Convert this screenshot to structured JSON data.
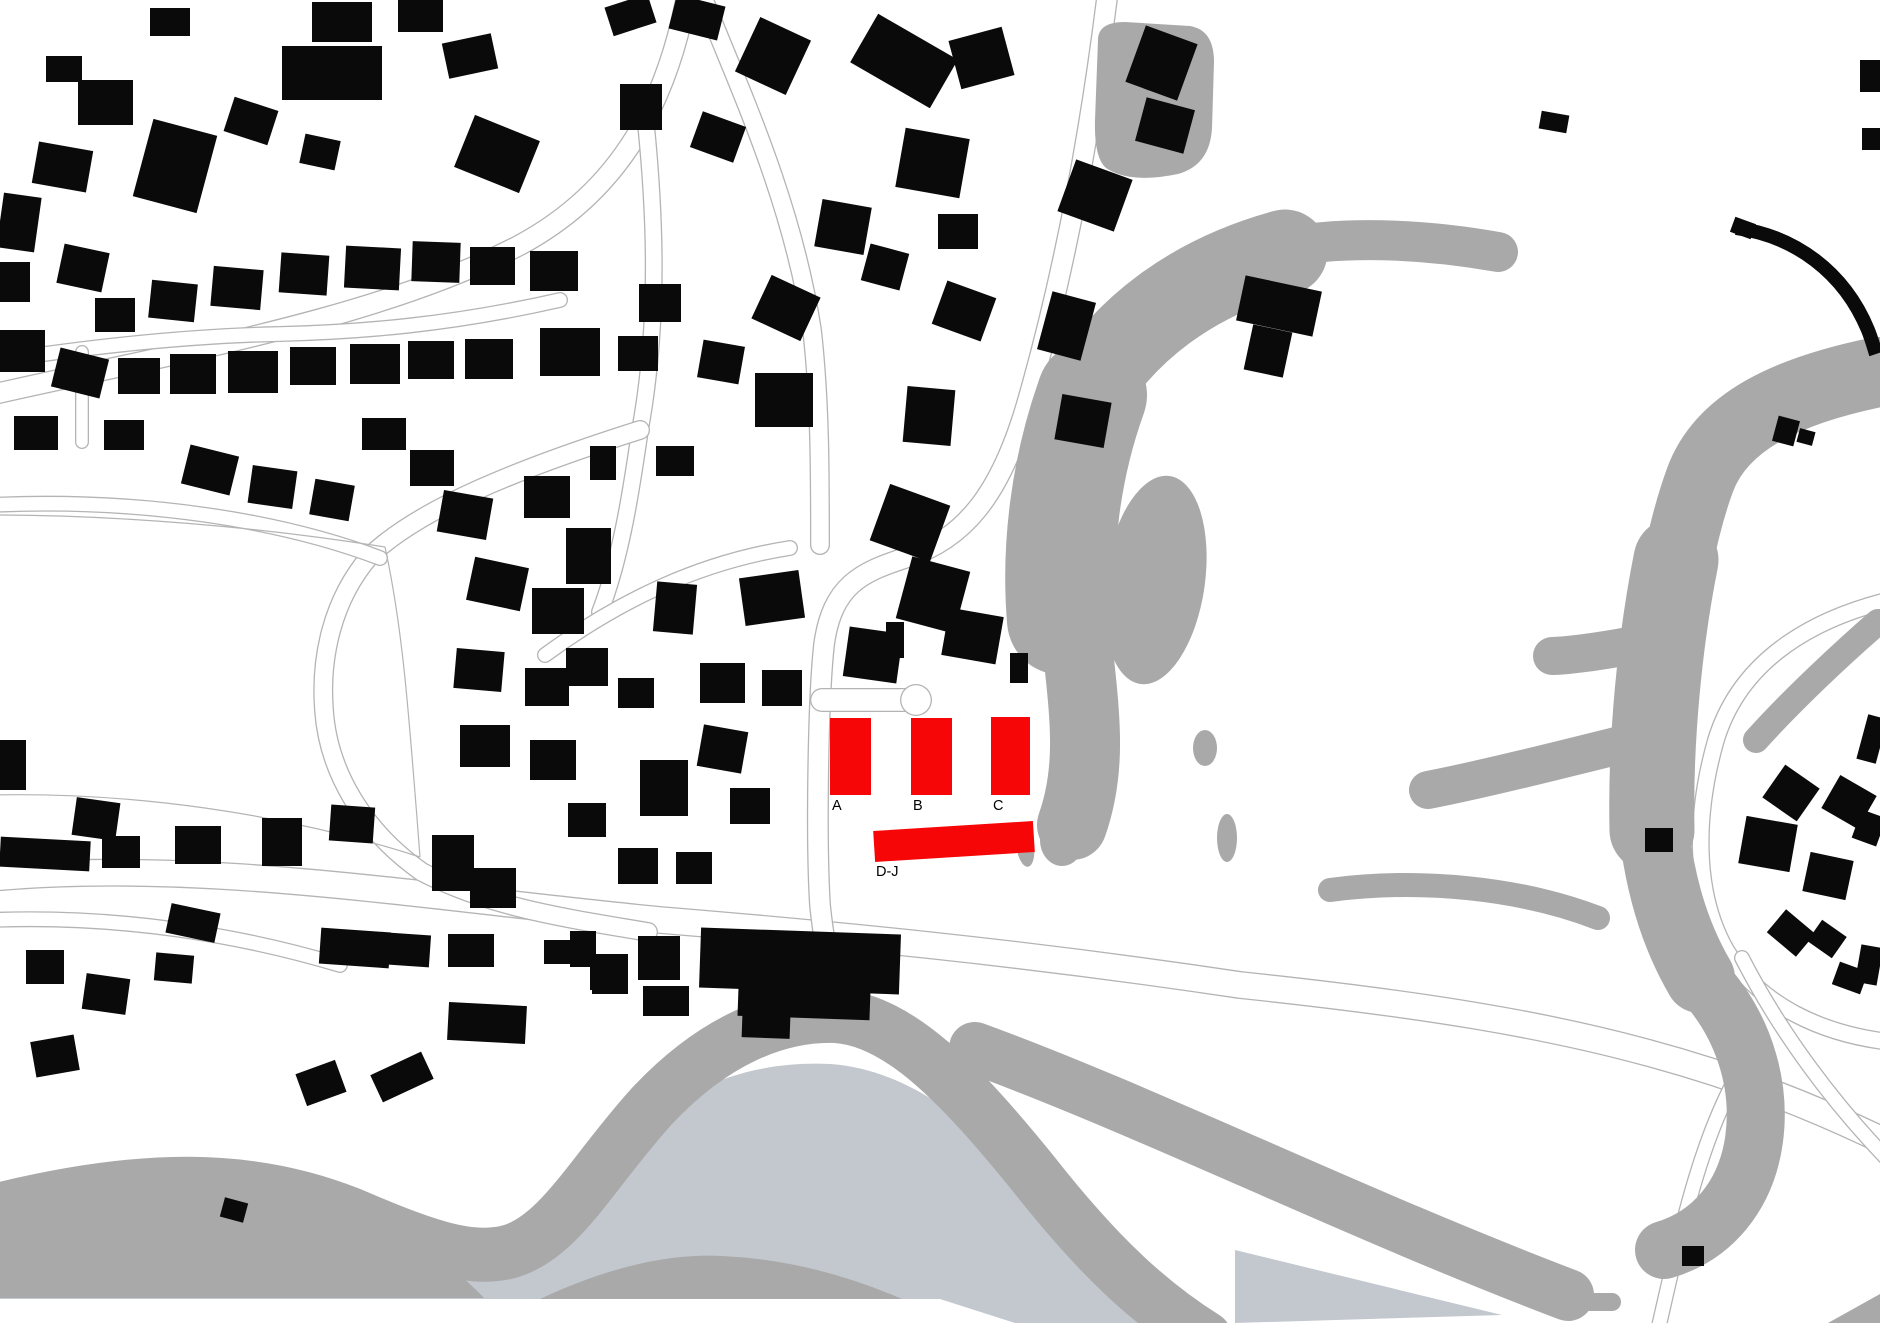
{
  "canvas": {
    "width": 1880,
    "height": 1323
  },
  "colors": {
    "background": "#ffffff",
    "building": "#0a0a0a",
    "highlight": "#f60606",
    "terrain": "#a9a9a9",
    "water": "#c3c8ce",
    "road_edge": "#b4b4b4",
    "label": "#000000"
  },
  "map": {
    "highlights": [
      {
        "id": "a",
        "label": "A",
        "x": 830,
        "y": 718,
        "w": 41,
        "h": 77,
        "rot": 0,
        "lx": 832,
        "ly": 810
      },
      {
        "id": "b",
        "label": "B",
        "x": 911,
        "y": 718,
        "w": 41,
        "h": 77,
        "rot": 0,
        "lx": 913,
        "ly": 810
      },
      {
        "id": "c",
        "label": "C",
        "x": 991,
        "y": 717,
        "w": 39,
        "h": 78,
        "rot": 0,
        "lx": 993,
        "ly": 810
      },
      {
        "id": "dj",
        "label": "D-J",
        "x": 874,
        "y": 826,
        "w": 160,
        "h": 31,
        "rot": -3.6,
        "lx": 876,
        "ly": 876
      }
    ],
    "roads": [
      {
        "d": "M -10,878 C 200,858 430,898 660,920 C 830,934 1020,952 1240,985 C 1430,1005 1545,1025 1645,1052 C 1735,1076 1812,1106 1890,1144",
        "w": 28
      },
      {
        "d": "M 1108,-10 C 1092,120 1068,260 1028,400 C 1000,498 962,540 905,558 C 862,572 832,585 824,645 C 818,700 816,840 820,905 C 822,925 824,937 826,947",
        "w": 22
      },
      {
        "d": "M 822,700 L 906,700",
        "w": 24
      },
      {
        "d": "M 700,-10 C 740,90 792,200 812,330 C 820,400 820,470 820,545",
        "w": 20
      },
      {
        "d": "M 688,-10 C 668,100 622,190 520,245 C 380,318 180,352 -10,395",
        "w": 22
      },
      {
        "d": "M 645,115 C 655,210 660,320 640,430 C 630,500 620,560 600,612",
        "w": 18
      },
      {
        "d": "M 560,300 C 450,325 360,332 280,334 C 180,336 80,348 -10,362",
        "w": 16
      },
      {
        "d": "M 640,430 C 520,468 420,508 370,556 C 332,600 320,658 324,710 C 328,770 362,830 422,872 C 492,908 566,918 648,932",
        "w": 20
      },
      {
        "d": "M -10,505 C 140,498 280,520 380,558",
        "w": 16
      },
      {
        "d": "M 545,655 C 620,600 700,562 790,548",
        "w": 16
      },
      {
        "d": "M 1890,600 C 1800,622 1738,668 1716,740 C 1696,810 1692,890 1726,950 C 1760,1006 1822,1034 1890,1042",
        "w": 18
      },
      {
        "d": "M 1742,958 C 1780,1032 1832,1102 1890,1162",
        "w": 16
      },
      {
        "d": "M 1658,1330 C 1680,1235 1700,1135 1745,1062",
        "w": 16
      },
      {
        "d": "M 82,352 L 82,442",
        "w": 14
      },
      {
        "d": "M -10,920 C 120,915 240,935 340,965",
        "w": 16
      }
    ],
    "road_lines": [
      "M -10,515 C 120,515 260,527 385,547",
      "M -10,795 C 130,792 280,812 420,857",
      "M 385,547 C 402,625 408,700 420,857"
    ],
    "culdesac": [
      916,
      700,
      16
    ],
    "terrain": [
      {
        "t": "fill",
        "c": "light",
        "d": "M -10,1245 C 140,1212 280,1212 400,1258 C 480,1290 540,1252 600,1172 C 660,1094 740,1060 830,1064 C 920,1070 1000,1142 1080,1242 C 1130,1296 1180,1323 1220,1323 L -10,1323 Z"
      },
      {
        "t": "fill",
        "c": "light",
        "d": "M 1235,1250 L 1502,1315 L 1235,1323 Z"
      },
      {
        "t": "stroke",
        "c": "dark",
        "w": 54,
        "d": "M -10,1212 C 140,1174 250,1174 350,1214 C 420,1244 468,1262 508,1252 C 560,1238 592,1172 652,1106 C 712,1042 776,1014 836,1016 C 900,1020 962,1086 1032,1172 C 1098,1256 1148,1302 1205,1338"
      },
      {
        "t": "fill",
        "c": "dark",
        "d": "M -10,1208 C 100,1172 230,1166 300,1188 C 380,1212 442,1254 484,1298 L -10,1298 Z"
      },
      {
        "t": "fill",
        "c": "white",
        "d": "M -10,1299 L 940,1299 L 1015,1323 L -10,1323 Z"
      },
      {
        "t": "fill",
        "c": "dark",
        "d": "M 540,1299 Q 640,1252 722,1256 Q 812,1260 902,1299 Z"
      },
      {
        "t": "stroke",
        "c": "dark",
        "w": 52,
        "d": "M 975,1048 C 1150,1112 1350,1212 1568,1295"
      },
      {
        "t": "fill",
        "c": "dark",
        "d": "M 1828,1323 L 1880,1294 L 1890,1294 L 1890,1323 Z"
      },
      {
        "t": "stroke",
        "c": "dark",
        "w": 18,
        "d": "M 1556,1302 L 1612,1302"
      },
      {
        "t": "fill",
        "c": "dark",
        "d": "M 1098,40 Q 1098,22 1125,22 L 1190,26 Q 1214,30 1214,62 L 1212,128 Q 1210,165 1178,174 Q 1130,184 1106,168 Q 1094,158 1095,120 Z"
      },
      {
        "t": "stroke",
        "c": "dark",
        "w": 40,
        "d": "M 1498,252 C 1420,238 1340,236 1280,248"
      },
      {
        "t": "stroke",
        "c": "dark",
        "w": 85,
        "d": "M 1285,252 C 1190,278 1125,330 1085,395"
      },
      {
        "t": "stroke",
        "c": "dark",
        "w": 110,
        "d": "M 1092,395 C 1065,470 1056,550 1062,620"
      },
      {
        "t": "stroke",
        "c": "dark",
        "w": 70,
        "d": "M 1075,620 C 1082,700 1095,760 1072,825"
      },
      {
        "t": "ellipse",
        "c": "dark",
        "cx": 1155,
        "cy": 580,
        "rx": 50,
        "ry": 105,
        "rot": 8
      },
      {
        "t": "ellipse",
        "c": "dark",
        "cx": 1062,
        "cy": 840,
        "rx": 22,
        "ry": 26,
        "rot": 0
      },
      {
        "t": "ellipse",
        "c": "dark",
        "cx": 1025,
        "cy": 845,
        "rx": 9,
        "ry": 22,
        "rot": -8
      },
      {
        "t": "ellipse",
        "c": "dark",
        "cx": 1227,
        "cy": 838,
        "rx": 10,
        "ry": 24,
        "rot": 0
      },
      {
        "t": "ellipse",
        "c": "dark",
        "cx": 1205,
        "cy": 748,
        "rx": 12,
        "ry": 18,
        "rot": 0
      },
      {
        "t": "stroke",
        "c": "dark",
        "w": 70,
        "d": "M 1878,372 C 1790,390 1722,420 1700,480 C 1680,535 1676,580 1660,640"
      },
      {
        "t": "stroke",
        "c": "dark",
        "w": 85,
        "d": "M 1676,560 C 1660,640 1650,740 1652,830"
      },
      {
        "t": "stroke",
        "c": "dark",
        "w": 38,
        "d": "M 1660,640 C 1620,648 1580,655 1552,656"
      },
      {
        "t": "stroke",
        "c": "dark",
        "w": 38,
        "d": "M 1640,740 C 1560,760 1480,780 1428,790"
      },
      {
        "t": "stroke",
        "c": "dark",
        "w": 26,
        "d": "M 1756,740 C 1792,700 1840,655 1878,622"
      },
      {
        "t": "stroke",
        "c": "dark",
        "w": 70,
        "d": "M 1654,832 C 1660,880 1672,930 1700,978"
      },
      {
        "t": "stroke",
        "c": "dark",
        "w": 58,
        "d": "M 1700,978 C 1742,1022 1762,1082 1754,1140 C 1746,1196 1712,1236 1664,1250"
      },
      {
        "t": "stroke",
        "c": "dark",
        "w": 24,
        "d": "M 1330,890 C 1420,878 1520,888 1598,918"
      }
    ],
    "buildings": [
      [
        46,
        56,
        36,
        26,
        0
      ],
      [
        78,
        80,
        55,
        45,
        0
      ],
      [
        150,
        8,
        40,
        28,
        0
      ],
      [
        312,
        2,
        60,
        40,
        0
      ],
      [
        398,
        0,
        45,
        32,
        0
      ],
      [
        282,
        46,
        100,
        54,
        0
      ],
      [
        228,
        103,
        46,
        36,
        18
      ],
      [
        142,
        126,
        66,
        80,
        15
      ],
      [
        302,
        137,
        36,
        30,
        12
      ],
      [
        462,
        126,
        70,
        56,
        22
      ],
      [
        445,
        38,
        50,
        36,
        -12
      ],
      [
        35,
        146,
        55,
        42,
        10
      ],
      [
        0,
        195,
        38,
        55,
        8
      ],
      [
        60,
        248,
        46,
        40,
        12
      ],
      [
        0,
        262,
        30,
        40,
        0
      ],
      [
        95,
        298,
        40,
        34,
        0
      ],
      [
        150,
        282,
        46,
        38,
        6
      ],
      [
        212,
        268,
        50,
        40,
        5
      ],
      [
        280,
        254,
        48,
        40,
        4
      ],
      [
        345,
        247,
        55,
        42,
        3
      ],
      [
        412,
        242,
        48,
        40,
        2
      ],
      [
        470,
        247,
        45,
        38,
        0
      ],
      [
        530,
        251,
        48,
        40,
        0
      ],
      [
        0,
        330,
        45,
        42,
        0
      ],
      [
        55,
        353,
        50,
        40,
        14
      ],
      [
        118,
        358,
        42,
        36,
        0
      ],
      [
        170,
        354,
        46,
        40,
        0
      ],
      [
        228,
        351,
        50,
        42,
        0
      ],
      [
        290,
        347,
        46,
        38,
        0
      ],
      [
        350,
        344,
        50,
        40,
        0
      ],
      [
        408,
        341,
        46,
        38,
        0
      ],
      [
        465,
        339,
        48,
        40,
        0
      ],
      [
        540,
        328,
        60,
        48,
        0
      ],
      [
        14,
        416,
        44,
        34,
        0
      ],
      [
        104,
        420,
        40,
        30,
        0
      ],
      [
        185,
        450,
        50,
        40,
        14
      ],
      [
        250,
        468,
        45,
        38,
        8
      ],
      [
        362,
        418,
        44,
        32,
        0
      ],
      [
        312,
        482,
        40,
        36,
        10
      ],
      [
        410,
        450,
        44,
        36,
        0
      ],
      [
        608,
        0,
        45,
        30,
        -18
      ],
      [
        672,
        0,
        50,
        35,
        14
      ],
      [
        745,
        26,
        56,
        60,
        25
      ],
      [
        620,
        84,
        42,
        46,
        0
      ],
      [
        695,
        118,
        46,
        38,
        20
      ],
      [
        858,
        33,
        92,
        56,
        30
      ],
      [
        954,
        33,
        55,
        50,
        -15
      ],
      [
        1134,
        33,
        55,
        60,
        20
      ],
      [
        1140,
        103,
        50,
        45,
        15
      ],
      [
        900,
        133,
        65,
        60,
        10
      ],
      [
        1065,
        168,
        60,
        55,
        20
      ],
      [
        818,
        203,
        50,
        48,
        10
      ],
      [
        938,
        214,
        40,
        35,
        0
      ],
      [
        865,
        248,
        40,
        38,
        15
      ],
      [
        759,
        284,
        54,
        48,
        25
      ],
      [
        938,
        288,
        52,
        46,
        20
      ],
      [
        1044,
        296,
        45,
        60,
        15
      ],
      [
        639,
        284,
        42,
        38,
        0
      ],
      [
        618,
        336,
        40,
        35,
        0
      ],
      [
        700,
        343,
        42,
        38,
        10
      ],
      [
        755,
        373,
        58,
        54,
        0
      ],
      [
        905,
        388,
        48,
        56,
        5
      ],
      [
        1058,
        398,
        50,
        46,
        10
      ],
      [
        1240,
        283,
        78,
        46,
        12
      ],
      [
        1248,
        328,
        40,
        46,
        12
      ],
      [
        1540,
        113,
        28,
        18,
        10
      ],
      [
        1860,
        60,
        20,
        32,
        0
      ],
      [
        1862,
        128,
        18,
        22,
        0
      ],
      [
        1732,
        220,
        22,
        16,
        20
      ],
      [
        1775,
        418,
        22,
        26,
        15
      ],
      [
        1798,
        430,
        16,
        14,
        15
      ],
      [
        590,
        446,
        26,
        34,
        0
      ],
      [
        656,
        446,
        38,
        30,
        0
      ],
      [
        566,
        528,
        45,
        56,
        0
      ],
      [
        655,
        583,
        40,
        50,
        5
      ],
      [
        742,
        574,
        60,
        48,
        -8
      ],
      [
        566,
        648,
        42,
        38,
        0
      ],
      [
        618,
        678,
        36,
        30,
        0
      ],
      [
        700,
        663,
        45,
        40,
        0
      ],
      [
        762,
        670,
        40,
        36,
        0
      ],
      [
        700,
        728,
        45,
        42,
        10
      ],
      [
        640,
        760,
        48,
        56,
        0
      ],
      [
        730,
        788,
        40,
        36,
        0
      ],
      [
        568,
        803,
        38,
        34,
        0
      ],
      [
        618,
        848,
        40,
        36,
        0
      ],
      [
        676,
        852,
        36,
        32,
        0
      ],
      [
        878,
        493,
        64,
        60,
        20
      ],
      [
        903,
        563,
        60,
        64,
        15
      ],
      [
        846,
        630,
        54,
        50,
        8
      ],
      [
        886,
        622,
        18,
        36,
        0
      ],
      [
        945,
        612,
        55,
        48,
        10
      ],
      [
        1010,
        653,
        18,
        30,
        0
      ],
      [
        440,
        494,
        50,
        42,
        10
      ],
      [
        524,
        476,
        46,
        42,
        0
      ],
      [
        470,
        562,
        55,
        44,
        12
      ],
      [
        532,
        588,
        52,
        46,
        0
      ],
      [
        455,
        650,
        48,
        40,
        5
      ],
      [
        525,
        668,
        44,
        38,
        0
      ],
      [
        460,
        725,
        50,
        42,
        0
      ],
      [
        530,
        740,
        46,
        40,
        0
      ],
      [
        0,
        740,
        26,
        50,
        0
      ],
      [
        0,
        839,
        90,
        30,
        3
      ],
      [
        74,
        800,
        44,
        38,
        8
      ],
      [
        102,
        836,
        38,
        32,
        0
      ],
      [
        175,
        826,
        46,
        38,
        0
      ],
      [
        262,
        818,
        40,
        48,
        0
      ],
      [
        330,
        806,
        44,
        36,
        4
      ],
      [
        432,
        835,
        42,
        56,
        0
      ],
      [
        470,
        868,
        46,
        40,
        0
      ],
      [
        168,
        908,
        50,
        30,
        12
      ],
      [
        320,
        930,
        70,
        36,
        4
      ],
      [
        388,
        934,
        42,
        32,
        4
      ],
      [
        448,
        934,
        46,
        33,
        0
      ],
      [
        544,
        940,
        34,
        24,
        0
      ],
      [
        590,
        962,
        33,
        28,
        0
      ],
      [
        448,
        1004,
        78,
        38,
        3
      ],
      [
        374,
        1062,
        56,
        30,
        -25
      ],
      [
        300,
        1066,
        42,
        34,
        -20
      ],
      [
        222,
        1200,
        24,
        20,
        15
      ],
      [
        26,
        950,
        38,
        34,
        0
      ],
      [
        84,
        976,
        44,
        36,
        8
      ],
      [
        155,
        954,
        38,
        28,
        5
      ],
      [
        33,
        1038,
        44,
        36,
        -10
      ],
      [
        570,
        931,
        26,
        36,
        0
      ],
      [
        592,
        954,
        36,
        40,
        0
      ],
      [
        638,
        936,
        42,
        44,
        0
      ],
      [
        643,
        986,
        46,
        30,
        0
      ],
      [
        700,
        931,
        200,
        60,
        2
      ],
      [
        738,
        988,
        132,
        30,
        2
      ],
      [
        742,
        1016,
        48,
        22,
        2
      ],
      [
        1645,
        828,
        28,
        24,
        0
      ],
      [
        1770,
        773,
        42,
        40,
        35
      ],
      [
        1828,
        783,
        42,
        38,
        30
      ],
      [
        1856,
        813,
        26,
        30,
        20
      ],
      [
        1742,
        820,
        52,
        48,
        10
      ],
      [
        1806,
        856,
        44,
        40,
        12
      ],
      [
        1862,
        716,
        20,
        46,
        15
      ],
      [
        1772,
        918,
        38,
        30,
        40
      ],
      [
        1812,
        926,
        30,
        26,
        35
      ],
      [
        1858,
        946,
        22,
        38,
        10
      ],
      [
        1835,
        966,
        30,
        24,
        20
      ],
      [
        1682,
        1246,
        22,
        20,
        0
      ]
    ],
    "building_arcs": [
      {
        "d": "M 1736,228 C 1795,236 1844,272 1868,330 C 1872,340 1874,348 1876,354",
        "w": 14
      }
    ]
  }
}
